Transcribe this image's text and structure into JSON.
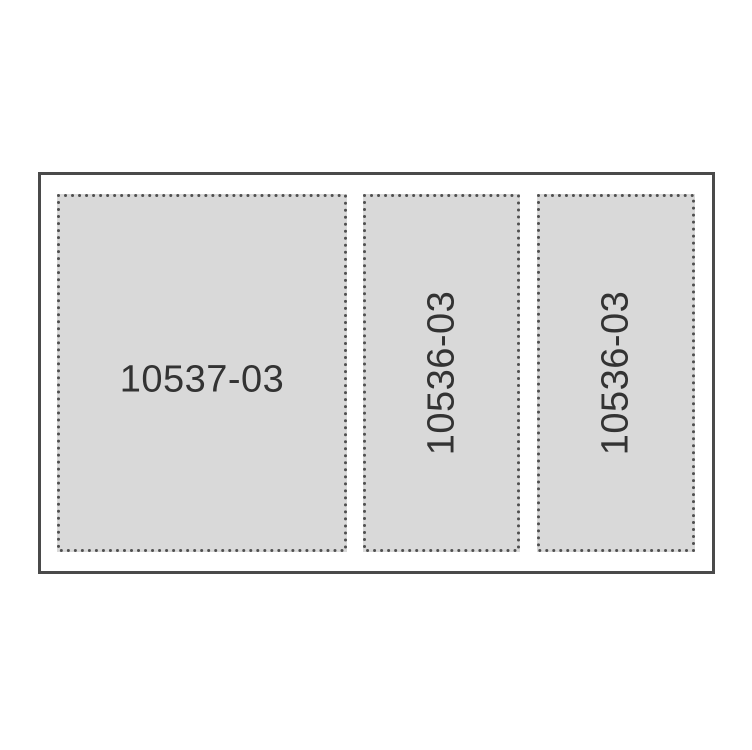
{
  "diagram": {
    "description": "Three dotted-outline glass panel sections with part numbers inside a solid outer frame",
    "colors": {
      "page-bg": "#ffffff",
      "outer-border": "#4a4a4a",
      "panel-fill": "#d9d9d9",
      "dot-color": "#4f4f4f",
      "label-color": "#333333"
    },
    "panels": [
      {
        "label": "10537-03",
        "orientation": "horizontal"
      },
      {
        "label": "10536-03",
        "orientation": "vertical"
      },
      {
        "label": "10536-03",
        "orientation": "vertical"
      }
    ]
  }
}
